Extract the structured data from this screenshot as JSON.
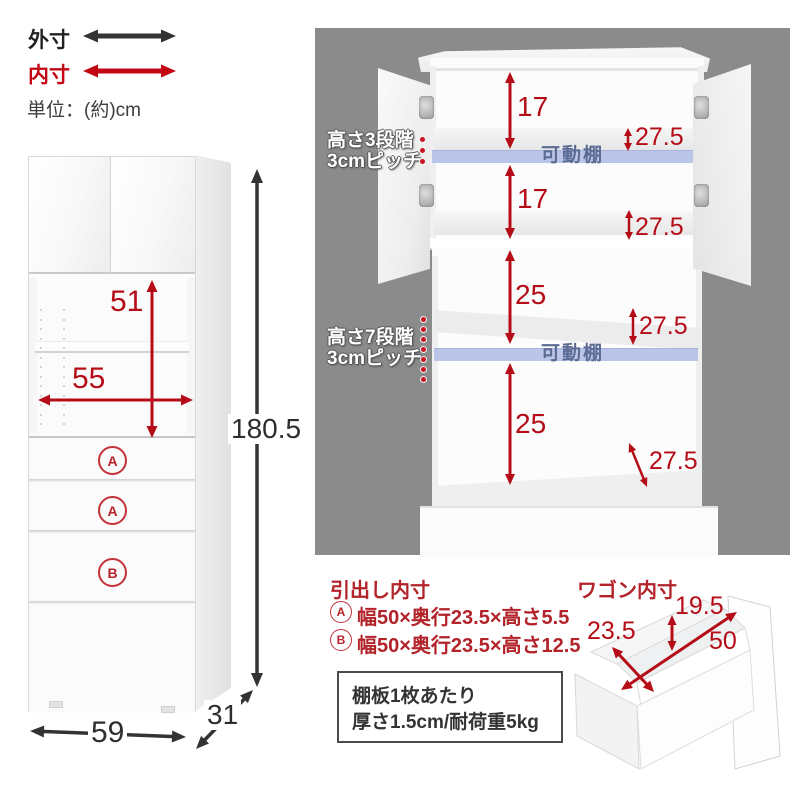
{
  "legend": {
    "outer_label": "外寸",
    "inner_label": "内寸",
    "unit": "単位：(約)cm"
  },
  "front_view": {
    "total_height": "180.5",
    "width": "59",
    "depth": "31",
    "shelf_height": "51",
    "shelf_width": "55",
    "drawer_labels": [
      "A",
      "A",
      "B"
    ]
  },
  "open_view": {
    "upper_pitch_line1": "高さ3段階",
    "upper_pitch_line2": "3cmピッチ",
    "lower_pitch_line1": "高さ7段階",
    "lower_pitch_line2": "3cmピッチ",
    "movable_shelves": [
      "可動棚",
      "可動棚"
    ],
    "upper_gaps": [
      "17",
      "17"
    ],
    "lower_gaps": [
      "25",
      "25"
    ],
    "depths": [
      "27.5",
      "27.5",
      "27.5",
      "27.5"
    ]
  },
  "drawer_specs": {
    "title": "引出し内寸",
    "rows": [
      {
        "label": "A",
        "text": "幅50×奥行23.5×高さ5.5"
      },
      {
        "label": "B",
        "text": "幅50×奥行23.5×高さ12.5"
      }
    ]
  },
  "shelf_note": {
    "line1": "棚板1枚あたり",
    "line2": "厚さ1.5cm/耐荷重5kg"
  },
  "wagon": {
    "title": "ワゴン内寸",
    "height": "19.5",
    "depth": "23.5",
    "width": "50"
  },
  "colors": {
    "dim_red": "#b50d17",
    "text_red": "#b2232a",
    "legend_red": "#c20613",
    "black": "#333333",
    "photo_bg": "#8b8b8b",
    "shelf_blue": "#b4c0e6",
    "shelf_text_blue": "#5c6b94"
  }
}
